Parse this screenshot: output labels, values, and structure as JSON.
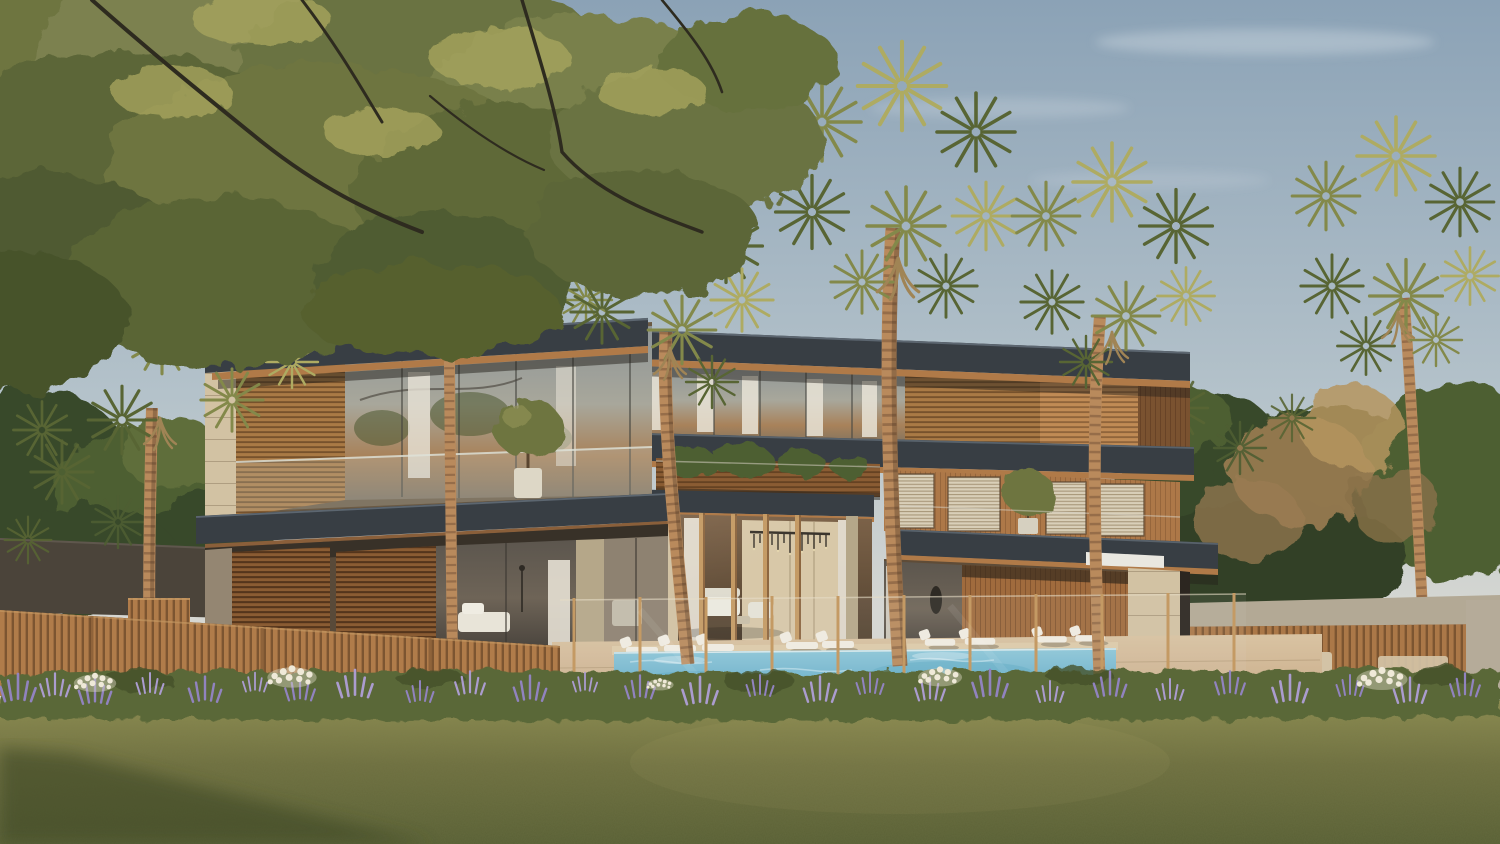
{
  "scene": {
    "type": "architectural-rendering",
    "description": "Photorealistic late-afternoon rendering of a modern tropical villa: layered charcoal flat-roof slabs with timber soffits, wood louvre screens, floor-to-ceiling glass, a double-height entrance porch with chandelier, swimming pool with white sun loungers behind a frameless glass fence, timber slat boundary fences, fan palms, lavender flower beds and a wide olive-green lawn under a hazy blue sky with a faint contrail.",
    "elements": [
      "sky",
      "clouds",
      "contrail",
      "deciduous-tree-canopy",
      "fan-palms",
      "villa-left-wing",
      "villa-center-entrance",
      "villa-right-wing",
      "rooftop-parapet",
      "balcony-planting",
      "chandelier",
      "swimming-pool",
      "sun-loungers",
      "glass-pool-fence",
      "timber-slat-fence",
      "boundary-wall",
      "stone-benches",
      "lavender-bed",
      "white-flowers",
      "lawn",
      "lawn-shadow"
    ]
  },
  "palette": {
    "skyTop": "#8ba2b6",
    "skyMid": "#b4c2ca",
    "skyHorizon": "#d6d7d2",
    "cloud": "#e9eef1",
    "contrail": "#eef3f5",
    "treeOlive": "#6e7441",
    "treeOliveDark": "#4d5830",
    "treeOliveLight": "#8f9154",
    "treeBacklit": "#aaa75e",
    "branch": "#2e2b1f",
    "bgTreeDark": "#38482a",
    "bgTreeMid": "#4e5e33",
    "blossom": "#9b7c52",
    "blossomLight": "#b5955f",
    "frondLight": "#aeab62",
    "frondMid": "#83894a",
    "frondDark": "#586534",
    "frondDead": "#a08455",
    "trunkLight": "#b98a5c",
    "trunkDark": "#7a563a",
    "trunkShade": "#4a3322",
    "roofCharcoal": "#383e44",
    "roofDark": "#2b3036",
    "roofHighlight": "#5c6670",
    "soffitWood": "#b07a48",
    "soffitWoodDark": "#8a5f3a",
    "woodLouver": "#a97a45",
    "woodLouverDark": "#8a5c33",
    "woodPanel": "#ad7848",
    "woodSlatBox": "#c08b55",
    "woodGround": "#a06b3d",
    "stoneLight": "#d2c2a3",
    "stoneShadow": "#b5a789",
    "stoneInner": "#d8c8a8",
    "glassAmber": "#a8825a",
    "glassGray": "#8e9597",
    "glassDark": "#55504a",
    "interiorDark": "#3a352d",
    "curtain": "#e9e4d7",
    "parapetWhite": "#e9e7e0",
    "poolLight": "#8ec7d9",
    "poolDeep": "#5ca8c4",
    "poolSparkle": "#d6edf4",
    "deckTan": "#c9ad8b",
    "deckLight": "#d9c3a2",
    "coping": "#ddcba9",
    "loungerWhite": "#f0ece1",
    "fenceWood": "#b07c4a",
    "fenceWoodDark": "#7c5531",
    "fenceWoodLit": "#c79a63",
    "glassPost": "#c49a64",
    "wallDark": "#4b443a",
    "wallCap": "#b3a995",
    "wallSlat": "#a3764c",
    "benchStone": "#d3c3a6",
    "bedGreen": "#5a6838",
    "bedGreenDark": "#45512c",
    "lavender": "#9183bf",
    "lavenderLight": "#ab9ccf",
    "flowerWhite": "#efe9d8",
    "lawnLight": "#8e8d51",
    "lawnBase": "#6f7040",
    "lawnDark": "#596035",
    "lawnShadow": "#3f4826",
    "porchTop": "#7d6349",
    "porchBottom": "#51412f"
  }
}
